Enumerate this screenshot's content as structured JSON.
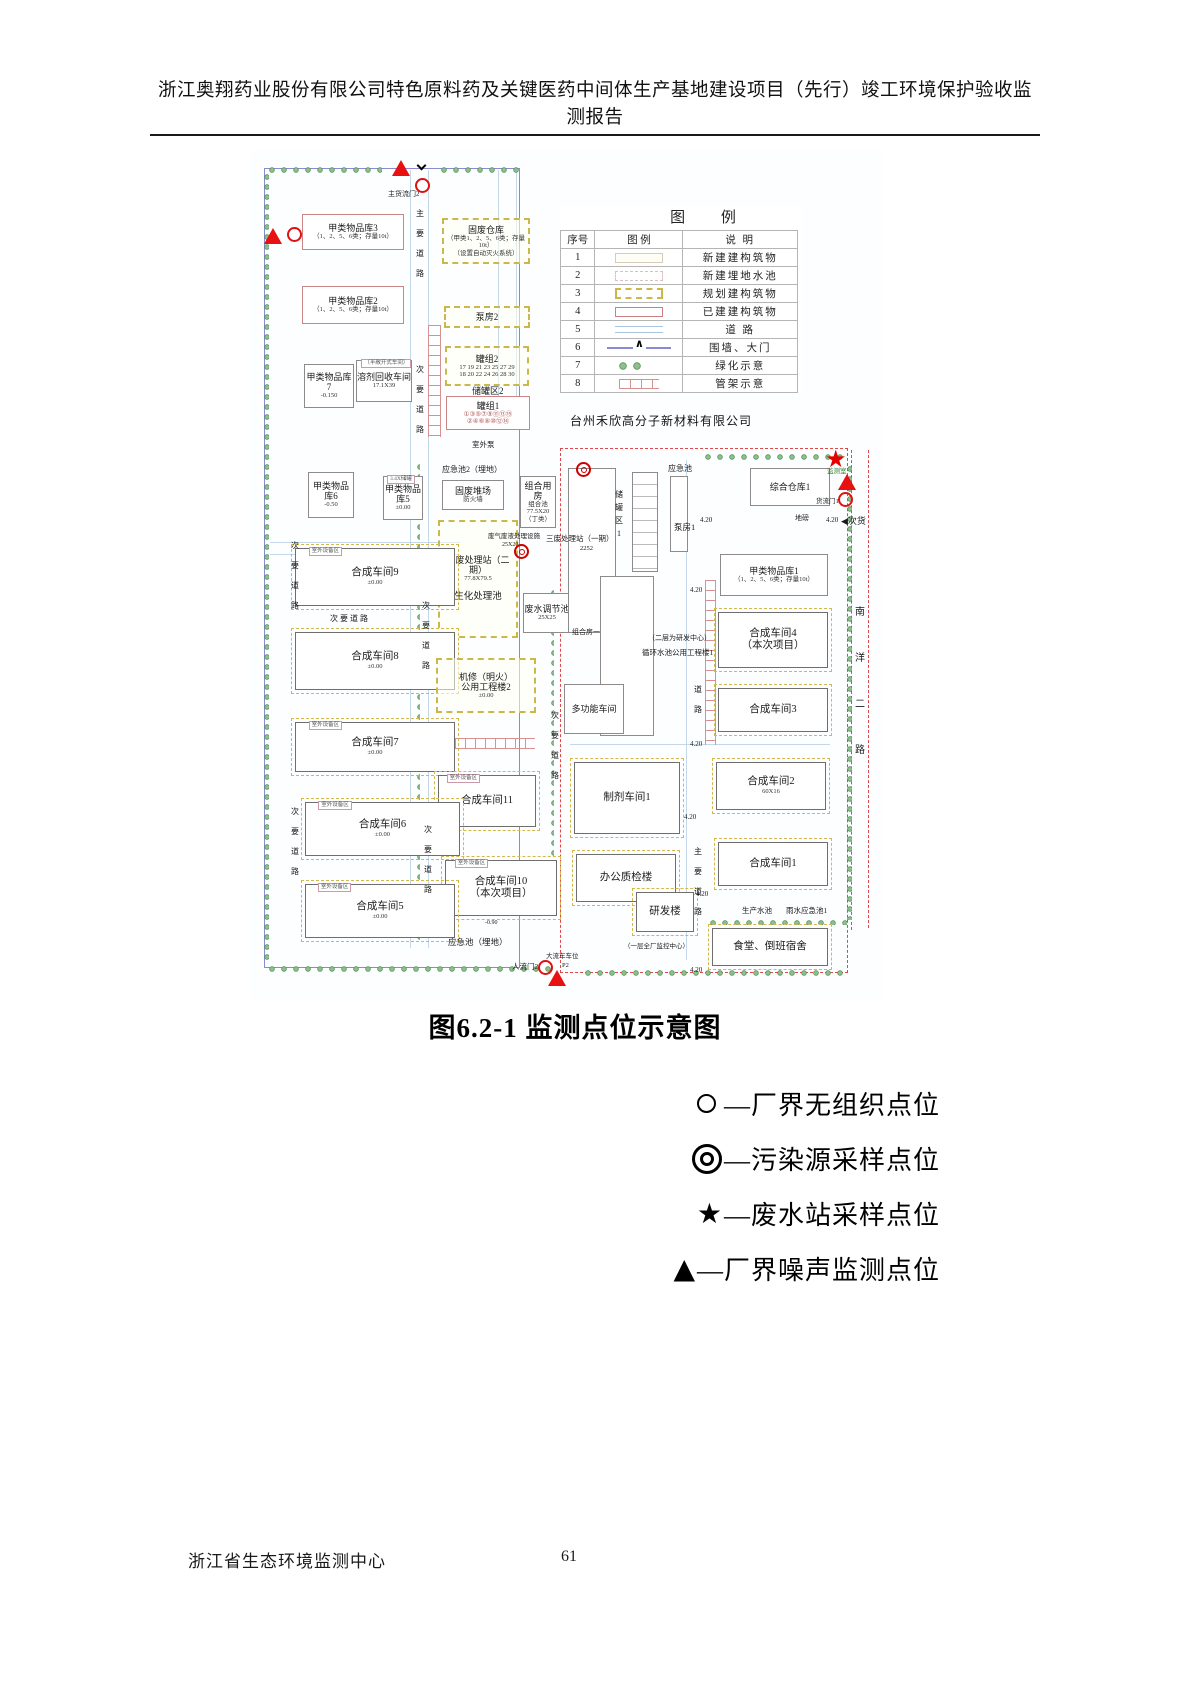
{
  "page": {
    "header_line1": "浙江奥翔药业股份有限公司特色原料药及关键医药中间体生产基地建设项目（先行）竣工环境保护验收监",
    "header_line2": "测报告",
    "caption": "图6.2-1  监测点位示意图",
    "footer_left": "浙江省生态环境监测中心",
    "page_number": "61"
  },
  "colors": {
    "marker_red": "#dd1111",
    "boundary_blue": "#8a8ad0",
    "boundary_red": "#e04848",
    "planned_yellow": "#ccb84a",
    "greenery_green": "#4f8f4f"
  },
  "legend_table": {
    "title": "图  例",
    "headers": [
      "序号",
      "图  例",
      "说  明"
    ],
    "rows": [
      {
        "no": "1",
        "swatch": "new-building",
        "desc": "新建建构筑物"
      },
      {
        "no": "2",
        "swatch": "new-buried-pool",
        "desc": "新建埋地水池"
      },
      {
        "no": "3",
        "swatch": "planned-building",
        "desc": "规划建构筑物"
      },
      {
        "no": "4",
        "swatch": "existing-building",
        "desc": "已建建构筑物"
      },
      {
        "no": "5",
        "swatch": "road",
        "desc": "道  路"
      },
      {
        "no": "6",
        "swatch": "wall-gate",
        "desc": "围墙、大门"
      },
      {
        "no": "7",
        "swatch": "greenery",
        "desc": "绿化示意"
      },
      {
        "no": "8",
        "swatch": "pipe-rack",
        "desc": "管架示意"
      }
    ]
  },
  "point_legend": [
    {
      "symbol": "circle",
      "glyph": "",
      "label": "—厂界无组织点位"
    },
    {
      "symbol": "double-circle",
      "glyph": "",
      "label": "—污染源采样点位"
    },
    {
      "symbol": "star",
      "glyph": "★",
      "label": "—废水站采样点位"
    },
    {
      "symbol": "triangle",
      "glyph": "▲",
      "label": "—厂界噪声监测点位"
    }
  ],
  "map": {
    "company_label": "台州禾欣高分子新材料有限公司",
    "boundaries": [
      {
        "x": 14,
        "y": 18,
        "w": 256,
        "h": 800,
        "cls": "blue"
      },
      {
        "x": 310,
        "y": 298,
        "w": 288,
        "h": 525,
        "cls": "red"
      },
      {
        "x": 601,
        "y": 300,
        "w": 0,
        "h": 480,
        "cls": "redv"
      },
      {
        "x": 618,
        "y": 300,
        "w": 0,
        "h": 478,
        "cls": "redv"
      }
    ],
    "roadlines": [
      {
        "x": 160,
        "y": 20,
        "w": 1,
        "h": 778
      },
      {
        "x": 178,
        "y": 20,
        "w": 1,
        "h": 778
      },
      {
        "x": 248,
        "y": 20,
        "w": 1,
        "h": 250
      },
      {
        "x": 266,
        "y": 20,
        "w": 1,
        "h": 250
      },
      {
        "x": 20,
        "y": 392,
        "w": 190,
        "h": 1
      },
      {
        "x": 20,
        "y": 404,
        "w": 190,
        "h": 1
      },
      {
        "x": 320,
        "y": 594,
        "w": 260,
        "h": 1
      },
      {
        "x": 436,
        "y": 310,
        "w": 1,
        "h": 500
      }
    ],
    "hedges": [
      {
        "x": 14,
        "y": 13,
        "w": 118,
        "h": 10
      },
      {
        "x": 186,
        "y": 13,
        "w": 84,
        "h": 10
      },
      {
        "x": 9,
        "y": 20,
        "w": 10,
        "h": 792,
        "v": true
      },
      {
        "x": 14,
        "y": 812,
        "w": 292,
        "h": 10
      },
      {
        "x": 330,
        "y": 816,
        "w": 268,
        "h": 10
      },
      {
        "x": 450,
        "y": 300,
        "w": 148,
        "h": 10
      },
      {
        "x": 592,
        "y": 312,
        "w": 10,
        "h": 458,
        "v": true
      },
      {
        "x": 455,
        "y": 766,
        "w": 142,
        "h": 9
      },
      {
        "x": 162,
        "y": 310,
        "w": 8,
        "h": 480,
        "v": true
      },
      {
        "x": 296,
        "y": 436,
        "w": 8,
        "h": 320,
        "v": true
      }
    ],
    "racks": [
      {
        "x": 178,
        "y": 175,
        "w": 13,
        "h": 112,
        "v": true
      },
      {
        "x": 185,
        "y": 588,
        "w": 100,
        "h": 11
      },
      {
        "x": 455,
        "y": 430,
        "w": 11,
        "h": 165,
        "v": true
      }
    ],
    "buildings": [
      {
        "l": "甲类物品库3",
        "subs": [
          "（1、2、5、6类；存量10t）"
        ],
        "x": 52,
        "y": 64,
        "w": 102,
        "h": 36,
        "st": "existing"
      },
      {
        "l": "固废仓库",
        "subs": [
          "（甲类1、2、5、6类；存量10t）",
          "（设置自动灭火系统）"
        ],
        "x": 192,
        "y": 68,
        "w": 88,
        "h": 46,
        "st": "planned"
      },
      {
        "l": "甲类物品库2",
        "subs": [
          "（1、2、5、6类；存量10t）"
        ],
        "x": 52,
        "y": 136,
        "w": 102,
        "h": 38,
        "st": "existing"
      },
      {
        "l": "泵房2",
        "x": 194,
        "y": 156,
        "w": 86,
        "h": 22,
        "st": "planned"
      },
      {
        "l": "罐组2",
        "subs": [
          "17 19 21 23 25 27 29",
          "18 20 22 24 26 28 30"
        ],
        "x": 195,
        "y": 196,
        "w": 84,
        "h": 40,
        "st": "planned"
      },
      {
        "l": "罐组1",
        "subs": [
          "①③⑤⑦⑨⑪⑬⑮",
          "②④⑥⑧⑩⑫⑭"
        ],
        "sc": "#b05555",
        "x": 196,
        "y": 246,
        "w": 84,
        "h": 34,
        "st": "existing"
      },
      {
        "l": "甲类物品库7",
        "subs": [
          "-0.150"
        ],
        "x": 54,
        "y": 214,
        "w": 50,
        "h": 44,
        "st": "plain"
      },
      {
        "l": "溶剂回收车间",
        "over": "（半敞开式车间）",
        "subs": [
          "17.1X39"
        ],
        "x": 106,
        "y": 210,
        "w": 56,
        "h": 42,
        "st": "plain"
      },
      {
        "l": "甲类物品库6",
        "subs": [
          "-0.50"
        ],
        "x": 58,
        "y": 322,
        "w": 46,
        "h": 46,
        "st": "plain"
      },
      {
        "l": "甲类物品库5",
        "over": "3.4X储罐",
        "subs": [
          "±0.00"
        ],
        "x": 133,
        "y": 326,
        "w": 40,
        "h": 44,
        "st": "plain"
      },
      {
        "l": "固废堆场",
        "subs": [
          "防火墙"
        ],
        "x": 192,
        "y": 330,
        "w": 62,
        "h": 30,
        "st": "plain"
      },
      {
        "l": "组合用房",
        "subs": [
          "组合池",
          "77.5X20",
          "（丁类）"
        ],
        "x": 270,
        "y": 326,
        "w": 36,
        "h": 52,
        "st": "plain"
      },
      {
        "l": "三废处理站（二期）",
        "subs": [
          "77.8X79.5"
        ],
        "mid": "生化处理池",
        "x": 188,
        "y": 370,
        "w": 80,
        "h": 118,
        "st": "planned"
      },
      {
        "l": "废水调节池",
        "subs": [
          "25X25"
        ],
        "x": 273,
        "y": 443,
        "w": 48,
        "h": 40,
        "st": "plain"
      },
      {
        "l": "合成车间9",
        "over": "室外设备区",
        "subs": [
          "±0.00"
        ],
        "x": 45,
        "y": 398,
        "w": 160,
        "h": 58,
        "st": "workshop"
      },
      {
        "l": "合成车间8",
        "subs": [
          "±0.00"
        ],
        "x": 45,
        "y": 482,
        "w": 160,
        "h": 58,
        "st": "workshop"
      },
      {
        "l": "机修（明火）",
        "l2": "公用工程楼2",
        "subs": [
          "±0.00"
        ],
        "x": 186,
        "y": 508,
        "w": 100,
        "h": 55,
        "st": "planned"
      },
      {
        "l": "合成车间7",
        "over": "室外设备区",
        "subs": [
          "±0.00"
        ],
        "x": 45,
        "y": 572,
        "w": 160,
        "h": 50,
        "st": "workshop"
      },
      {
        "l": "合成车间11",
        "over": "室外设备区",
        "x": 188,
        "y": 625,
        "w": 98,
        "h": 52,
        "st": "workshop"
      },
      {
        "l": "合成车间6",
        "over": "室外设备区",
        "subs": [
          "±0.00"
        ],
        "x": 55,
        "y": 652,
        "w": 155,
        "h": 54,
        "st": "workshop"
      },
      {
        "l": "合成车间10",
        "l2": "（本次项目）",
        "over": "室外设备区",
        "x": 195,
        "y": 710,
        "w": 112,
        "h": 56,
        "st": "workshop"
      },
      {
        "l": "合成车间5",
        "over": "室外设备区",
        "subs": [
          "±0.00"
        ],
        "x": 55,
        "y": 734,
        "w": 150,
        "h": 54,
        "st": "workshop"
      },
      {
        "l": "",
        "x": 318,
        "y": 318,
        "w": 48,
        "h": 165,
        "st": "plain"
      },
      {
        "l": "",
        "x": 382,
        "y": 322,
        "w": 26,
        "h": 100,
        "st": "ruled plain"
      },
      {
        "l": "",
        "x": 420,
        "y": 326,
        "w": 18,
        "h": 76,
        "st": "plain"
      },
      {
        "l": "综合仓库1",
        "x": 500,
        "y": 318,
        "w": 80,
        "h": 38,
        "st": "plain"
      },
      {
        "l": "甲类物品库1",
        "subs": [
          "（1、2、5、6类；存量10t）"
        ],
        "x": 470,
        "y": 404,
        "w": 108,
        "h": 42,
        "st": "plain"
      },
      {
        "l": "合成车间4",
        "l2": "（本次项目）",
        "x": 468,
        "y": 462,
        "w": 110,
        "h": 56,
        "st": "workshop"
      },
      {
        "l": "合成车间3",
        "x": 468,
        "y": 538,
        "w": 110,
        "h": 44,
        "st": "workshop"
      },
      {
        "l": "合成车间2",
        "subs": [
          "60X16"
        ],
        "x": 466,
        "y": 612,
        "w": 110,
        "h": 48,
        "st": "workshop"
      },
      {
        "l": "合成车间1",
        "x": 468,
        "y": 692,
        "w": 110,
        "h": 44,
        "st": "workshop"
      },
      {
        "l": "",
        "x": 350,
        "y": 426,
        "w": 54,
        "h": 160,
        "st": "plain"
      },
      {
        "l": "多功能车间",
        "x": 314,
        "y": 534,
        "w": 60,
        "h": 50,
        "st": "plain"
      },
      {
        "l": "制剂车间1",
        "x": 324,
        "y": 612,
        "w": 106,
        "h": 72,
        "st": "workshop"
      },
      {
        "l": "办公质检楼",
        "x": 326,
        "y": 704,
        "w": 100,
        "h": 48,
        "st": "workshop"
      },
      {
        "l": "研发楼",
        "x": 386,
        "y": 742,
        "w": 58,
        "h": 40,
        "st": "workshop"
      },
      {
        "l": "食堂、倒班宿舍",
        "x": 462,
        "y": 778,
        "w": 116,
        "h": 38,
        "st": "workshop"
      }
    ],
    "labels": [
      {
        "t": "主货流门2",
        "x": 138,
        "y": 40,
        "s": 7
      },
      {
        "t": "主要道路",
        "x": 163,
        "y": 54,
        "v": true
      },
      {
        "t": "次要道路",
        "x": 163,
        "y": 210,
        "v": true
      },
      {
        "t": "次要道路",
        "x": 169,
        "y": 446,
        "v": true
      },
      {
        "t": "次要道路",
        "x": 171,
        "y": 670,
        "v": true
      },
      {
        "t": "次要道路",
        "x": 38,
        "y": 386,
        "v": true
      },
      {
        "t": "次要道路",
        "x": 38,
        "y": 652,
        "v": true
      },
      {
        "t": "次要道路",
        "x": 298,
        "y": 556,
        "v": true
      },
      {
        "t": "道路",
        "x": 441,
        "y": 530,
        "v": true
      },
      {
        "t": "主要道路",
        "x": 441,
        "y": 692,
        "v": true
      },
      {
        "t": "南洋二路",
        "x": 603,
        "y": 440,
        "v": true,
        "lh": 46,
        "s": 10
      },
      {
        "t": "次 要 道 路",
        "x": 80,
        "y": 464,
        "s": 8
      },
      {
        "t": "储罐区2",
        "x": 222,
        "y": 236,
        "s": 9
      },
      {
        "t": "室外泵",
        "x": 222,
        "y": 290,
        "s": 7.5
      },
      {
        "t": "应急池2（埋地）",
        "x": 192,
        "y": 315,
        "s": 8
      },
      {
        "t": "废气废液处理设施",
        "x": 238,
        "y": 383,
        "s": 6.5
      },
      {
        "t": "25X20",
        "x": 252,
        "y": 392,
        "s": 6
      },
      {
        "t": "三废处理站（一期）",
        "x": 296,
        "y": 384,
        "s": 7.5
      },
      {
        "t": "2252",
        "x": 330,
        "y": 395,
        "s": 6.5
      },
      {
        "t": "组合房一",
        "x": 322,
        "y": 478,
        "s": 7
      },
      {
        "t": "储罐区1",
        "x": 362,
        "y": 338,
        "v": true,
        "lh": 13,
        "s": 8
      },
      {
        "t": "应急池",
        "x": 418,
        "y": 314,
        "s": 8
      },
      {
        "t": "泵房1",
        "x": 424,
        "y": 372,
        "s": 8.5
      },
      {
        "t": "（二层为研发中心）",
        "x": 398,
        "y": 484,
        "s": 7
      },
      {
        "t": "循环水池公用工程楼1",
        "x": 392,
        "y": 498,
        "s": 7.5
      },
      {
        "t": "地磅",
        "x": 545,
        "y": 364,
        "s": 7
      },
      {
        "t": "货流门1",
        "x": 566,
        "y": 348,
        "s": 6.5
      },
      {
        "t": "监测室",
        "x": 577,
        "y": 318,
        "s": 6.5,
        "c": "#2a7a2a"
      },
      {
        "t": "◀次货",
        "x": 591,
        "y": 366,
        "s": 9
      },
      {
        "t": "生产水池",
        "x": 492,
        "y": 756,
        "s": 7.5
      },
      {
        "t": "雨水应急池1",
        "x": 536,
        "y": 756,
        "s": 7.5
      },
      {
        "t": "（一层全厂监控中心）",
        "x": 374,
        "y": 793,
        "s": 6.5
      },
      {
        "t": "大流车车位",
        "x": 296,
        "y": 803,
        "s": 6.5
      },
      {
        "t": "P2",
        "x": 312,
        "y": 812,
        "s": 6.5
      },
      {
        "t": "人流门2",
        "x": 262,
        "y": 812,
        "s": 7.5
      },
      {
        "t": "应急池（埋地）",
        "x": 198,
        "y": 787,
        "s": 8.5
      },
      {
        "t": "-0.90",
        "x": 235,
        "y": 770,
        "s": 6
      },
      {
        "t": "4.20",
        "x": 450,
        "y": 366,
        "s": 7
      },
      {
        "t": "4.20",
        "x": 576,
        "y": 366,
        "s": 7
      },
      {
        "t": "4.20",
        "x": 440,
        "y": 436,
        "s": 7
      },
      {
        "t": "4.20",
        "x": 440,
        "y": 590,
        "s": 7
      },
      {
        "t": "4.20",
        "x": 434,
        "y": 663,
        "s": 7
      },
      {
        "t": "4.20",
        "x": 446,
        "y": 740,
        "s": 7
      },
      {
        "t": "4.20",
        "x": 440,
        "y": 816,
        "s": 7
      }
    ],
    "markers": [
      {
        "type": "tri",
        "x": 142,
        "y": 10
      },
      {
        "type": "chev",
        "x": 168,
        "y": 12
      },
      {
        "type": "circ",
        "x": 165,
        "y": 28
      },
      {
        "type": "circ",
        "x": 37,
        "y": 77
      },
      {
        "type": "tri",
        "x": 14,
        "y": 78
      },
      {
        "type": "dcirc",
        "x": 326,
        "y": 312
      },
      {
        "type": "dcirc",
        "x": 264,
        "y": 394
      },
      {
        "type": "star",
        "x": 575,
        "y": 298
      },
      {
        "type": "tri",
        "x": 588,
        "y": 324
      },
      {
        "type": "circ",
        "x": 588,
        "y": 342
      },
      {
        "type": "circ",
        "x": 288,
        "y": 810
      },
      {
        "type": "tri",
        "x": 298,
        "y": 820
      }
    ]
  }
}
